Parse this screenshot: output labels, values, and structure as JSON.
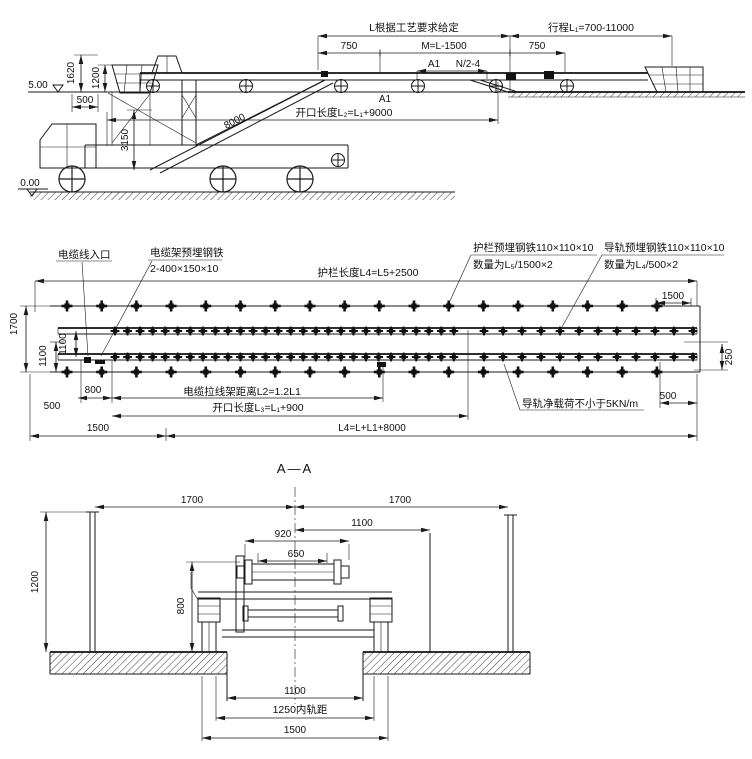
{
  "colors": {
    "ink": "#1a1a1a",
    "paper": "#ffffff"
  },
  "top_view": {
    "l_note": "L根据工艺要求给定",
    "stroke": "行程L₁=700-11000",
    "d750a": "750",
    "dM": "M=L-1500",
    "d750b": "750",
    "a1_top": "A1",
    "dN": "N/2-4",
    "a1_bot": "A1",
    "opening": "开口长度L₂=L₁+9000",
    "elev_top": "5.00",
    "elev_ground": "0.00",
    "d1620": "1620",
    "d1200": "1200",
    "d500": "500",
    "d3150": "3150",
    "d8000": "8000"
  },
  "plan_view": {
    "cable_entry": "电缆线入口",
    "cable_rack1": "电缆架预埋钢铁",
    "cable_rack2": "2-400×150×10",
    "guardrail_len": "护栏长度L4=L5+2500",
    "guardrail_steel1": "护栏预埋钢铁110×110×10",
    "guardrail_steel2": "数量为L₅/1500×2",
    "rail_steel1": "导轨预埋钢铁110×110×10",
    "rail_steel2": "数量为L₄/500×2",
    "d1500_top": "1500",
    "d1700": "1700",
    "d1100a": "1100",
    "d1100b": "1100",
    "d800": "800",
    "d500l": "500",
    "d1500l": "1500",
    "cable_rack_dist": "电缆拉线架距离L2=1.2L1",
    "opening_len": "开口长度L₃=L₁+900",
    "total_len": "L4=L+L1+8000",
    "rail_load": "导轨净载荷不小于5KN/m",
    "d250": "250",
    "d500r": "500"
  },
  "section_view": {
    "title": "A—A",
    "d1700l": "1700",
    "d1700r": "1700",
    "d1100t": "1100",
    "d920": "920",
    "d650": "650",
    "d1200": "1200",
    "d800": "800",
    "d1100b": "1100",
    "gauge": "1250内轨距",
    "d1500": "1500"
  }
}
